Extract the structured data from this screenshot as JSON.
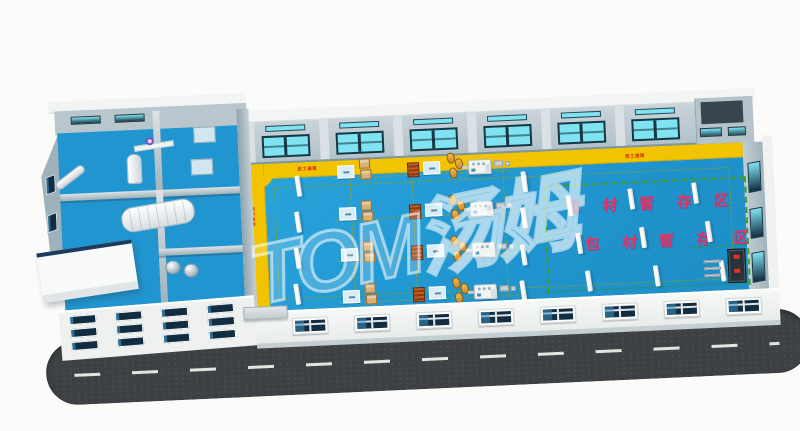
{
  "watermark": {
    "text": "TOM汤姆"
  },
  "labels": {
    "storage_zone_line1": "包 材 暂 存 区",
    "storage_zone_line2": "包 材 暂 存 区",
    "walkway": "员工通道"
  },
  "colors": {
    "background": "#fbfbf9",
    "floor": "#2095cf",
    "walkway": "#f2c400",
    "wall": "#bfccd3",
    "roof_edge": "#f3f5f4",
    "facade": "#f0f3f1",
    "glass_cyan": "#7fe3f2",
    "glass_navy": "#122c42",
    "frame_dark": "#173744",
    "road": "#3e4144",
    "road_line": "#f2f2ee",
    "zone_border": "#3f9e1e",
    "zone_text": "#e0366c",
    "walkway_text": "#cf2b12",
    "lane_line": "#b09a00",
    "carton": "#d9b176",
    "rack": "#bf4f1c",
    "sack": "#e2a53c",
    "pallet": "#d8edf6",
    "machine": "#f2f4f3",
    "watermark_stroke": "rgba(255,255,255,0.55)"
  },
  "back_wall": {
    "bays": 6
  },
  "right_wall": {
    "window_ys": [
      178,
      224,
      268
    ]
  },
  "facade": {
    "window_count": 8,
    "start_x": 36,
    "step": 62,
    "y": 6
  },
  "annex_facade": {
    "row_ys": [
      4,
      17,
      30
    ],
    "col_xs": [
      10,
      56,
      102,
      148
    ]
  },
  "floor": {
    "row_ys": [
      163,
      205,
      246,
      288
    ],
    "stations": [
      {
        "type": "pallet",
        "x": 340
      },
      {
        "type": "cartons",
        "x": 362
      },
      {
        "type": "rack",
        "x": 410
      },
      {
        "type": "pallet",
        "x": 426
      },
      {
        "type": "sacks",
        "x": 450
      },
      {
        "type": "filler",
        "x": 471
      },
      {
        "type": "bits",
        "x": 497
      }
    ],
    "lane_xs": [
      352,
      414,
      505
    ],
    "columns": [
      [
        298,
        171
      ],
      [
        296,
        207
      ],
      [
        294,
        243
      ],
      [
        292,
        279
      ],
      [
        524,
        177
      ],
      [
        522,
        213
      ],
      [
        520,
        250
      ],
      [
        518,
        286
      ],
      [
        568,
        203
      ],
      [
        576,
        241
      ],
      [
        584,
        279
      ],
      [
        630,
        199
      ],
      [
        640,
        238
      ],
      [
        652,
        277
      ],
      [
        694,
        196
      ],
      [
        706,
        235
      ],
      [
        718,
        275
      ]
    ]
  },
  "walkway_labels": [
    {
      "x": 300,
      "y": 161,
      "rot": 0
    },
    {
      "x": 628,
      "y": 163,
      "rot": 0
    },
    {
      "x": 257,
      "y": 200,
      "rot": 90
    },
    {
      "x": 255,
      "y": 270,
      "rot": 90
    }
  ]
}
